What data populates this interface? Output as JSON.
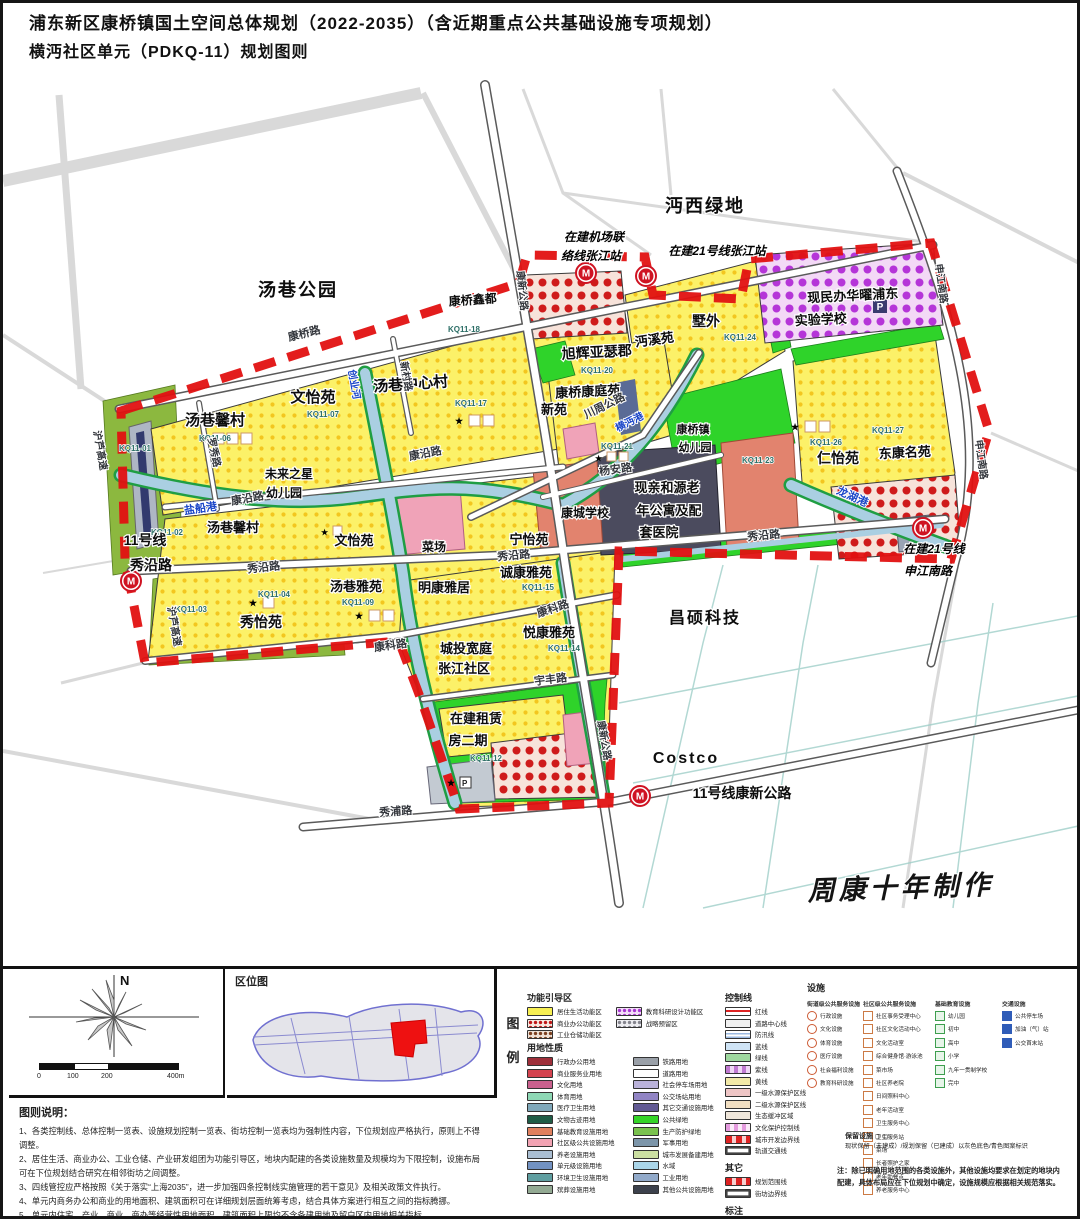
{
  "title": {
    "line1": "浦东新区康桥镇国土空间总体规划（2022-2035）（含近期重点公共基础设施专项规划）",
    "line2": "横沔社区单元（PDKQ-11）规划图则"
  },
  "map": {
    "accent_colors": {
      "boundary_red": "#e11111",
      "residential_yellow": "#fcf168",
      "park_green": "#2fd32a",
      "water_blue": "#aacfe2",
      "school_purple": "#b535d8"
    },
    "labels": [
      {
        "t": "汤巷公园",
        "x": 295,
        "y": 293,
        "s": 18,
        "c": "big"
      },
      {
        "t": "沔西绿地",
        "x": 702,
        "y": 209,
        "s": 18,
        "c": "big"
      },
      {
        "t": "昌硕科技",
        "x": 702,
        "y": 620,
        "s": 16,
        "c": "big"
      },
      {
        "t": "Costco",
        "x": 683,
        "y": 760,
        "s": 16,
        "c": "big"
      },
      {
        "t": "周康十年制作",
        "x": 898,
        "y": 894,
        "s": 27,
        "r": -2,
        "c": "wm"
      },
      {
        "t": "汤巷馨村",
        "x": 212,
        "y": 422,
        "s": 15
      },
      {
        "t": "KQ11-06",
        "x": 212,
        "y": 438,
        "s": 8,
        "c": "cd"
      },
      {
        "t": "文怡苑",
        "x": 310,
        "y": 399,
        "s": 15
      },
      {
        "t": "KQ11-07",
        "x": 320,
        "y": 414,
        "s": 8,
        "c": "cd"
      },
      {
        "t": "汤巷中心村",
        "x": 408,
        "y": 386,
        "s": 15,
        "r": -4
      },
      {
        "t": "KQ11-17",
        "x": 468,
        "y": 403,
        "s": 8,
        "c": "cd"
      },
      {
        "t": "康桥鑫都",
        "x": 470,
        "y": 301,
        "s": 12,
        "r": -4
      },
      {
        "t": "KQ11-18",
        "x": 461,
        "y": 329,
        "s": 8,
        "c": "cd"
      },
      {
        "t": "旭辉亚瑟郡",
        "x": 594,
        "y": 354,
        "s": 14,
        "r": -3
      },
      {
        "t": "KQ11-20",
        "x": 594,
        "y": 370,
        "s": 8,
        "c": "cd"
      },
      {
        "t": "沔溪苑",
        "x": 652,
        "y": 341,
        "s": 13,
        "r": -8
      },
      {
        "t": "墅外",
        "x": 703,
        "y": 323,
        "s": 14
      },
      {
        "t": "KQ11-24",
        "x": 737,
        "y": 337,
        "s": 8,
        "c": "cd"
      },
      {
        "t": "现民办华曜浦东",
        "x": 850,
        "y": 297,
        "s": 13,
        "r": -3
      },
      {
        "t": "实验学校",
        "x": 818,
        "y": 321,
        "s": 13,
        "r": -3
      },
      {
        "t": "康桥康庭苑",
        "x": 585,
        "y": 393,
        "s": 13,
        "r": -3
      },
      {
        "t": "新苑",
        "x": 551,
        "y": 411,
        "s": 13
      },
      {
        "t": "仁怡苑",
        "x": 835,
        "y": 460,
        "s": 14
      },
      {
        "t": "KQ11-26",
        "x": 823,
        "y": 442,
        "s": 8,
        "c": "cd"
      },
      {
        "t": "东康名苑",
        "x": 902,
        "y": 454,
        "s": 13,
        "r": -3
      },
      {
        "t": "KQ11-27",
        "x": 885,
        "y": 430,
        "s": 8,
        "c": "cd"
      },
      {
        "t": "汤巷馨村",
        "x": 230,
        "y": 529,
        "s": 13
      },
      {
        "t": "文怡苑",
        "x": 351,
        "y": 542,
        "s": 13
      },
      {
        "t": "菜场",
        "x": 431,
        "y": 548,
        "s": 12
      },
      {
        "t": "宁怡苑",
        "x": 526,
        "y": 541,
        "s": 13
      },
      {
        "t": "诚康雅苑",
        "x": 523,
        "y": 574,
        "s": 13
      },
      {
        "t": "KQ11-15",
        "x": 535,
        "y": 587,
        "s": 8,
        "c": "cd"
      },
      {
        "t": "明康雅居",
        "x": 441,
        "y": 589,
        "s": 13
      },
      {
        "t": "汤巷雅苑",
        "x": 353,
        "y": 588,
        "s": 13
      },
      {
        "t": "KQ11-09",
        "x": 355,
        "y": 602,
        "s": 8,
        "c": "cd"
      },
      {
        "t": "秀怡苑",
        "x": 258,
        "y": 624,
        "s": 14
      },
      {
        "t": "KQ11-04",
        "x": 271,
        "y": 594,
        "s": 8,
        "c": "cd"
      },
      {
        "t": "悦康雅苑",
        "x": 546,
        "y": 634,
        "s": 13
      },
      {
        "t": "KQ11-14",
        "x": 561,
        "y": 648,
        "s": 8,
        "c": "cd"
      },
      {
        "t": "城投宽庭",
        "x": 463,
        "y": 650,
        "s": 13
      },
      {
        "t": "张江社区",
        "x": 461,
        "y": 670,
        "s": 13
      },
      {
        "t": "在建租赁",
        "x": 473,
        "y": 720,
        "s": 13
      },
      {
        "t": "房二期",
        "x": 465,
        "y": 742,
        "s": 13
      },
      {
        "t": "KQ11-12",
        "x": 483,
        "y": 758,
        "s": 8,
        "c": "cd"
      },
      {
        "t": "康桥镇",
        "x": 690,
        "y": 430,
        "s": 11
      },
      {
        "t": "幼儿园",
        "x": 692,
        "y": 448,
        "s": 11
      },
      {
        "t": "KQ11-21",
        "x": 614,
        "y": 446,
        "s": 8,
        "c": "cd"
      },
      {
        "t": "KQ11-23",
        "x": 755,
        "y": 460,
        "s": 8,
        "c": "cd"
      },
      {
        "t": "现亲和源老",
        "x": 664,
        "y": 489,
        "s": 13
      },
      {
        "t": "年公寓及配",
        "x": 666,
        "y": 512,
        "s": 13
      },
      {
        "t": "套医院",
        "x": 656,
        "y": 534,
        "s": 13
      },
      {
        "t": "康城学校",
        "x": 582,
        "y": 514,
        "s": 12
      },
      {
        "t": "未来之星",
        "x": 286,
        "y": 475,
        "s": 12
      },
      {
        "t": "幼儿园",
        "x": 281,
        "y": 494,
        "s": 12
      },
      {
        "t": "KQ11-01",
        "x": 132,
        "y": 448,
        "s": 8,
        "c": "cd"
      },
      {
        "t": "KQ11-02",
        "x": 164,
        "y": 532,
        "s": 8,
        "c": "cd"
      },
      {
        "t": "KQ11-03",
        "x": 188,
        "y": 609,
        "s": 8,
        "c": "cd"
      },
      {
        "t": "在建机场联",
        "x": 591,
        "y": 238,
        "s": 12,
        "c": "st"
      },
      {
        "t": "络线张江站",
        "x": 588,
        "y": 257,
        "s": 12,
        "c": "st"
      },
      {
        "t": "在建21号线张江站",
        "x": 714,
        "y": 252,
        "s": 12,
        "c": "st"
      },
      {
        "t": "11号线",
        "x": 142,
        "y": 542,
        "s": 14
      },
      {
        "t": "秀沿路",
        "x": 148,
        "y": 567,
        "s": 14
      },
      {
        "t": "在建21号线",
        "x": 931,
        "y": 550,
        "s": 12,
        "c": "st"
      },
      {
        "t": "申江南路",
        "x": 925,
        "y": 572,
        "s": 12,
        "c": "st"
      },
      {
        "t": "11号线康新公路",
        "x": 739,
        "y": 795,
        "s": 14
      },
      {
        "t": "康桥路",
        "x": 302,
        "y": 334,
        "s": 11,
        "r": -14,
        "c": "r"
      },
      {
        "t": "新村路",
        "x": 400,
        "y": 374,
        "s": 10,
        "r": 80,
        "c": "r"
      },
      {
        "t": "康新公路",
        "x": 516,
        "y": 288,
        "s": 10,
        "r": 84,
        "c": "r"
      },
      {
        "t": "康新公路",
        "x": 598,
        "y": 738,
        "s": 10,
        "r": 80,
        "c": "r"
      },
      {
        "t": "康沿路",
        "x": 423,
        "y": 454,
        "s": 11,
        "r": -11,
        "c": "r"
      },
      {
        "t": "康沿路",
        "x": 245,
        "y": 499,
        "s": 11,
        "r": -10,
        "c": "r"
      },
      {
        "t": "秀沿路",
        "x": 261,
        "y": 568,
        "s": 11,
        "r": -6,
        "c": "r"
      },
      {
        "t": "秀沿路",
        "x": 511,
        "y": 556,
        "s": 11,
        "r": -5,
        "c": "r"
      },
      {
        "t": "秀沿路",
        "x": 761,
        "y": 536,
        "s": 11,
        "r": -5,
        "c": "r"
      },
      {
        "t": "康科路",
        "x": 388,
        "y": 646,
        "s": 11,
        "r": -8,
        "c": "r"
      },
      {
        "t": "康科路",
        "x": 551,
        "y": 609,
        "s": 11,
        "r": -18,
        "c": "r"
      },
      {
        "t": "宇丰路",
        "x": 548,
        "y": 680,
        "s": 11,
        "r": -7,
        "c": "r"
      },
      {
        "t": "秀浦路",
        "x": 393,
        "y": 812,
        "s": 11,
        "r": -4,
        "c": "r"
      },
      {
        "t": "川周公路",
        "x": 603,
        "y": 406,
        "s": 11,
        "r": -26,
        "c": "r"
      },
      {
        "t": "杨安路",
        "x": 613,
        "y": 470,
        "s": 11,
        "r": -8,
        "c": "r"
      },
      {
        "t": "申江南路",
        "x": 935,
        "y": 281,
        "s": 10,
        "r": 82,
        "c": "r"
      },
      {
        "t": "申江南路",
        "x": 975,
        "y": 457,
        "s": 10,
        "r": 82,
        "c": "r"
      },
      {
        "t": "罗秀路",
        "x": 208,
        "y": 450,
        "s": 10,
        "r": 78,
        "c": "r"
      },
      {
        "t": "沪芦高速",
        "x": 94,
        "y": 448,
        "s": 10,
        "r": 80,
        "c": "r"
      },
      {
        "t": "沪芦高速",
        "x": 168,
        "y": 624,
        "s": 10,
        "r": 80,
        "c": "r"
      },
      {
        "t": "盐船港",
        "x": 198,
        "y": 509,
        "s": 11,
        "r": -8,
        "c": "b"
      },
      {
        "t": "创业河",
        "x": 348,
        "y": 382,
        "s": 10,
        "r": 80,
        "c": "b"
      },
      {
        "t": "龙湖港",
        "x": 848,
        "y": 497,
        "s": 11,
        "r": 24,
        "c": "b"
      },
      {
        "t": "横沔港",
        "x": 628,
        "y": 422,
        "s": 10,
        "r": -27,
        "c": "b"
      }
    ]
  },
  "bottom": {
    "compass_n": "N",
    "scale_ticks": [
      "0",
      "100",
      "200",
      "400m"
    ],
    "location_map_title": "区位图",
    "legend": {
      "legend_label_1": "图",
      "legend_label_2": "例",
      "function_zones": {
        "title": "功能引导区",
        "col1": [
          {
            "label": "居住生活功能区",
            "cls": "p-solid-yellow"
          },
          {
            "label": "商业办公功能区",
            "cls": "p-dots-red"
          },
          {
            "label": "工业仓储功能区",
            "cls": "p-dots-brown"
          }
        ],
        "col2": [
          {
            "label": "教育科研设计功能区",
            "cls": "p-dots-purple"
          },
          {
            "label": "战略预留区",
            "cls": "p-dots-gray"
          }
        ]
      },
      "land_use": {
        "title": "用地性质",
        "col1": [
          {
            "label": "行政办公用地",
            "swatch": "#9e2f3a"
          },
          {
            "label": "商业服务业用地",
            "swatch": "#d4434f"
          },
          {
            "label": "文化用地",
            "swatch": "#c9608d"
          },
          {
            "label": "体育用地",
            "swatch": "#8ed8b5"
          },
          {
            "label": "医疗卫生用地",
            "swatch": "#80a8ba"
          },
          {
            "label": "文物古迹用地",
            "swatch": "#1f5c46"
          },
          {
            "label": "基础教育设施用地",
            "swatch": "#e0805e"
          },
          {
            "label": "社区级公共设施用地",
            "swatch": "#f2a3b3"
          },
          {
            "label": "养老设施用地",
            "swatch": "#aabed2"
          },
          {
            "label": "单元级设施用地",
            "swatch": "#7292c2"
          },
          {
            "label": "环境卫生设施用地",
            "swatch": "#5f9ea0"
          },
          {
            "label": "殡葬设施用地",
            "swatch": "#93aa93"
          }
        ],
        "col2": [
          {
            "label": "铁路用地",
            "swatch": "#9aa0a8"
          },
          {
            "label": "道路用地",
            "swatch": "#ffffff"
          },
          {
            "label": "社会停车场用地",
            "swatch": "#bab2da"
          },
          {
            "label": "公交场站用地",
            "swatch": "#9184c4"
          },
          {
            "label": "其它交通设施用地",
            "swatch": "#625a94"
          },
          {
            "label": "公共绿地",
            "swatch": "#35d428"
          },
          {
            "label": "生产防护绿地",
            "swatch": "#7ac24e"
          },
          {
            "label": "军事用地",
            "swatch": "#7d96aa"
          },
          {
            "label": "城市发展备建用地",
            "swatch": "#cce0a2"
          },
          {
            "label": "水域",
            "swatch": "#abd6e9"
          },
          {
            "label": "工业用地",
            "swatch": "#92aaca"
          },
          {
            "label": "其他公共设施用地",
            "swatch": "#3c414c"
          }
        ]
      },
      "control_lines": {
        "title": "控制线",
        "items": [
          {
            "label": "红线",
            "cls": "p-line-red"
          },
          {
            "label": "道路中心线",
            "swatch": "#f0f0f0"
          },
          {
            "label": "防汛线",
            "cls": "p-stripe-blue"
          },
          {
            "label": "蓝线",
            "swatch": "#cfe4f6"
          },
          {
            "label": "绿线",
            "swatch": "#9fd89f"
          },
          {
            "label": "紫线",
            "cls": "p-stripe-purple"
          },
          {
            "label": "黄线",
            "swatch": "#f2e9a8"
          },
          {
            "label": "一级水源保护区线",
            "swatch": "#efc6c6"
          },
          {
            "label": "二级水源保护区线",
            "swatch": "#f2dfc2"
          },
          {
            "label": "生态缓冲区域",
            "swatch": "#efe6da"
          },
          {
            "label": "文化保护控制线",
            "cls": "p-stripe-pink"
          },
          {
            "label": "城市开发边界线",
            "cls": "p-dash-red"
          },
          {
            "label": "轨道交通线",
            "cls": "p-rail"
          }
        ]
      },
      "others": {
        "title": "其它",
        "items": [
          {
            "label": "规划范围线",
            "cls": "p-dash-red"
          },
          {
            "label": "街坊边界线",
            "cls": "p-rail"
          }
        ]
      },
      "annotation": {
        "title": "标注",
        "items": [
          {
            "label": "尺寸标注（米）",
            "cls": "p-ticks"
          }
        ]
      },
      "facilities": {
        "title": "设施",
        "groups": [
          {
            "title": "街道级公共服务设施",
            "items": [
              "行政设施",
              "文化设施",
              "体育设施",
              "医疗设施",
              "社会福利设施",
              "教育科研设施"
            ]
          },
          {
            "title": "社区级公共服务设施",
            "items": [
              "社区事务受理中心",
              "社区文化活动中心",
              "文化活动室",
              "综合健身馆·游泳池",
              "菜市场",
              "社区养老院",
              "日间照料中心",
              "老年活动室",
              "卫生服务中心",
              "卫生服务站",
              "菜场",
              "长者照护之家",
              "老年助餐点",
              "养老服务中心"
            ]
          },
          {
            "title": "基础教育设施",
            "items": [
              "幼儿园",
              "初中",
              "高中",
              "小学",
              "九年一贯制学校",
              "完中"
            ]
          },
          {
            "title": "交通设施",
            "items": [
              "公共停车场",
              "加油（气）站",
              "公交首末站"
            ]
          }
        ],
        "retained_label": "保留设施",
        "retained_note": "现状保留（未建成）/规划保留（已建成）以灰色底色/青色图案标识",
        "note": "注：除已明确用地范围的各类设施外，其他设施均要求在划定的地块内配建，具体布局应在下位规划中确定，设施规模应根据相关规范落实。"
      }
    },
    "notes": {
      "title": "图则说明：",
      "lines": [
        "1、各类控制线、总体控制一览表、设施规划控制一览表、街坊控制一览表均为强制性内容，下位规划应严格执行，原则上不得调整。",
        "2、居住生活、商业办公、工业仓储、产业研发组团为功能引导区，地块内配建的各类设施数量及规模均为下限控制，设施布局可在下位规划结合研究在相邻街坊之间调整。",
        "3、四线管控应严格按照《关于落实“上海2035”，进一步加强四条控制线实施管理的若干意见》及相关政策文件执行。",
        "4、单元内商务办公和商业的用地面积、建筑面积可在详细规划层面统筹考虑，结合具体方案进行相互之间的指标腾挪。",
        "5、单元内住宅、产业、商业、商办等经营性用地面积、建筑面积上限均不含备建用地及留白区内用地相关指标。",
        "6、在各类建筑面积的统计中，现状建筑面积按已批规划数据和地形图计算，单体建筑的准确建筑面积以相关法律文件为准。"
      ]
    }
  }
}
